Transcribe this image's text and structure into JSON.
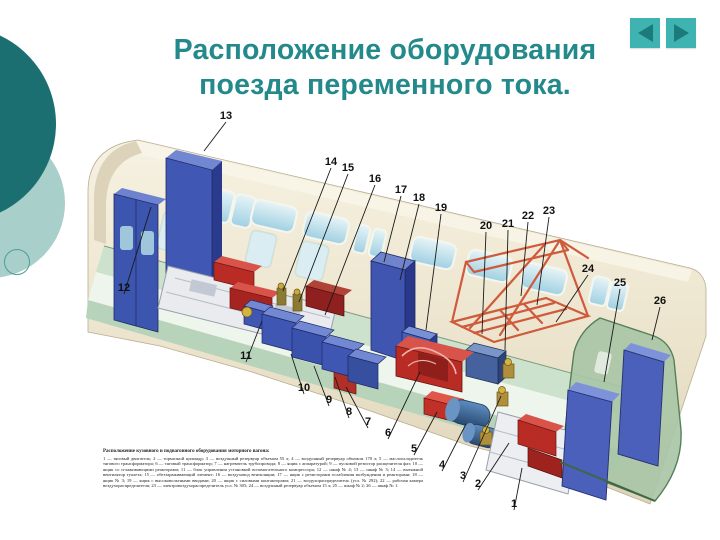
{
  "slide": {
    "title_lines": [
      "Расположение оборудования",
      "поезда переменного тока."
    ]
  },
  "nav": {
    "prev_icon": "triangle-left",
    "next_icon": "triangle-right"
  },
  "colors": {
    "title": "#23898b",
    "nav_button_bg": "#3fb3b1",
    "nav_arrow": "#1c7b79",
    "circle_dark": "#1b6f70",
    "circle_light": "#a8cfc9",
    "car_body": "#efe8d4",
    "floor_green": "#cde2cd",
    "cabinet_blue": "#3f57b2",
    "equipment_red": "#b92c26",
    "frame_orange": "#cf5a3c"
  },
  "diagram": {
    "caption_title": "Расположение кузовного и подвагонного оборудования моторного вагона:",
    "caption_body": "1 — тяговый двигатель; 2 — тормозной цилиндр; 3 — воздушный резервуар объемом 55 л; 4 — воздушный резервуар объемом 170 л; 5 — маслоохладитель тягового трансформатора; 6 — тяговый трансформатор; 7 — нагреватель трубопровода; 8 — ящик с аппаратурой; 9 — пусковой резистор расщепителя фаз; 10 — ящик со сглаживающими реакторами; 11 — блок управления установкой вспомогательного компрессора; 12 — шкаф № 4; 13 — шкаф № 3; 14 — вытяжной вентилятор туалета; 15 — обеззараживающий элемент; 16 — воздуховод вентиляции; 17 — ящик с резисторами ослабления возбуждения и реакторами; 18 — ящик № 3; 19 — ящик с высоковольтными вводами; 20 — ящик с силовыми контакторами; 21 — воздухораспределитель (усл. № 292); 22 — рабочая камера воздухораспределителя; 23 — электровоздухораспределитель усл. № 305; 24 — воздушный резервуар объемом 15 л; 25 — шкаф № 2; 26 — шкаф № 1.",
    "callouts": [
      {
        "n": "1",
        "x": 514,
        "y": 507,
        "tx": 522,
        "ty": 468
      },
      {
        "n": "2",
        "x": 478,
        "y": 487,
        "tx": 509,
        "ty": 443
      },
      {
        "n": "3",
        "x": 463,
        "y": 479,
        "tx": 501,
        "ty": 396
      },
      {
        "n": "4",
        "x": 442,
        "y": 468,
        "tx": 466,
        "ty": 424
      },
      {
        "n": "5",
        "x": 414,
        "y": 452,
        "tx": 437,
        "ty": 412
      },
      {
        "n": "6",
        "x": 388,
        "y": 436,
        "tx": 420,
        "ty": 372
      },
      {
        "n": "7",
        "x": 368,
        "y": 425,
        "tx": 346,
        "ty": 387
      },
      {
        "n": "8",
        "x": 349,
        "y": 415,
        "tx": 335,
        "ty": 377
      },
      {
        "n": "9",
        "x": 329,
        "y": 403,
        "tx": 314,
        "ty": 366
      },
      {
        "n": "10",
        "x": 304,
        "y": 391,
        "tx": 291,
        "ty": 354
      },
      {
        "n": "11",
        "x": 246,
        "y": 359,
        "tx": 262,
        "ty": 321
      },
      {
        "n": "12",
        "x": 124,
        "y": 291,
        "tx": 151,
        "ty": 207
      },
      {
        "n": "13",
        "x": 226,
        "y": 119,
        "tx": 204,
        "ty": 151
      },
      {
        "n": "14",
        "x": 331,
        "y": 165,
        "tx": 283,
        "ty": 291
      },
      {
        "n": "15",
        "x": 348,
        "y": 171,
        "tx": 299,
        "ty": 302
      },
      {
        "n": "16",
        "x": 375,
        "y": 182,
        "tx": 325,
        "ty": 315
      },
      {
        "n": "17",
        "x": 401,
        "y": 193,
        "tx": 384,
        "ty": 262
      },
      {
        "n": "18",
        "x": 419,
        "y": 201,
        "tx": 400,
        "ty": 280
      },
      {
        "n": "19",
        "x": 441,
        "y": 211,
        "tx": 426,
        "ty": 330
      },
      {
        "n": "20",
        "x": 486,
        "y": 229,
        "tx": 482,
        "ty": 334
      },
      {
        "n": "21",
        "x": 508,
        "y": 227,
        "tx": 505,
        "ty": 350
      },
      {
        "n": "22",
        "x": 528,
        "y": 219,
        "tx": 521,
        "ty": 296
      },
      {
        "n": "23",
        "x": 549,
        "y": 214,
        "tx": 537,
        "ty": 305
      },
      {
        "n": "24",
        "x": 588,
        "y": 272,
        "tx": 556,
        "ty": 322
      },
      {
        "n": "25",
        "x": 620,
        "y": 286,
        "tx": 604,
        "ty": 382
      },
      {
        "n": "26",
        "x": 660,
        "y": 304,
        "tx": 652,
        "ty": 340
      }
    ]
  }
}
